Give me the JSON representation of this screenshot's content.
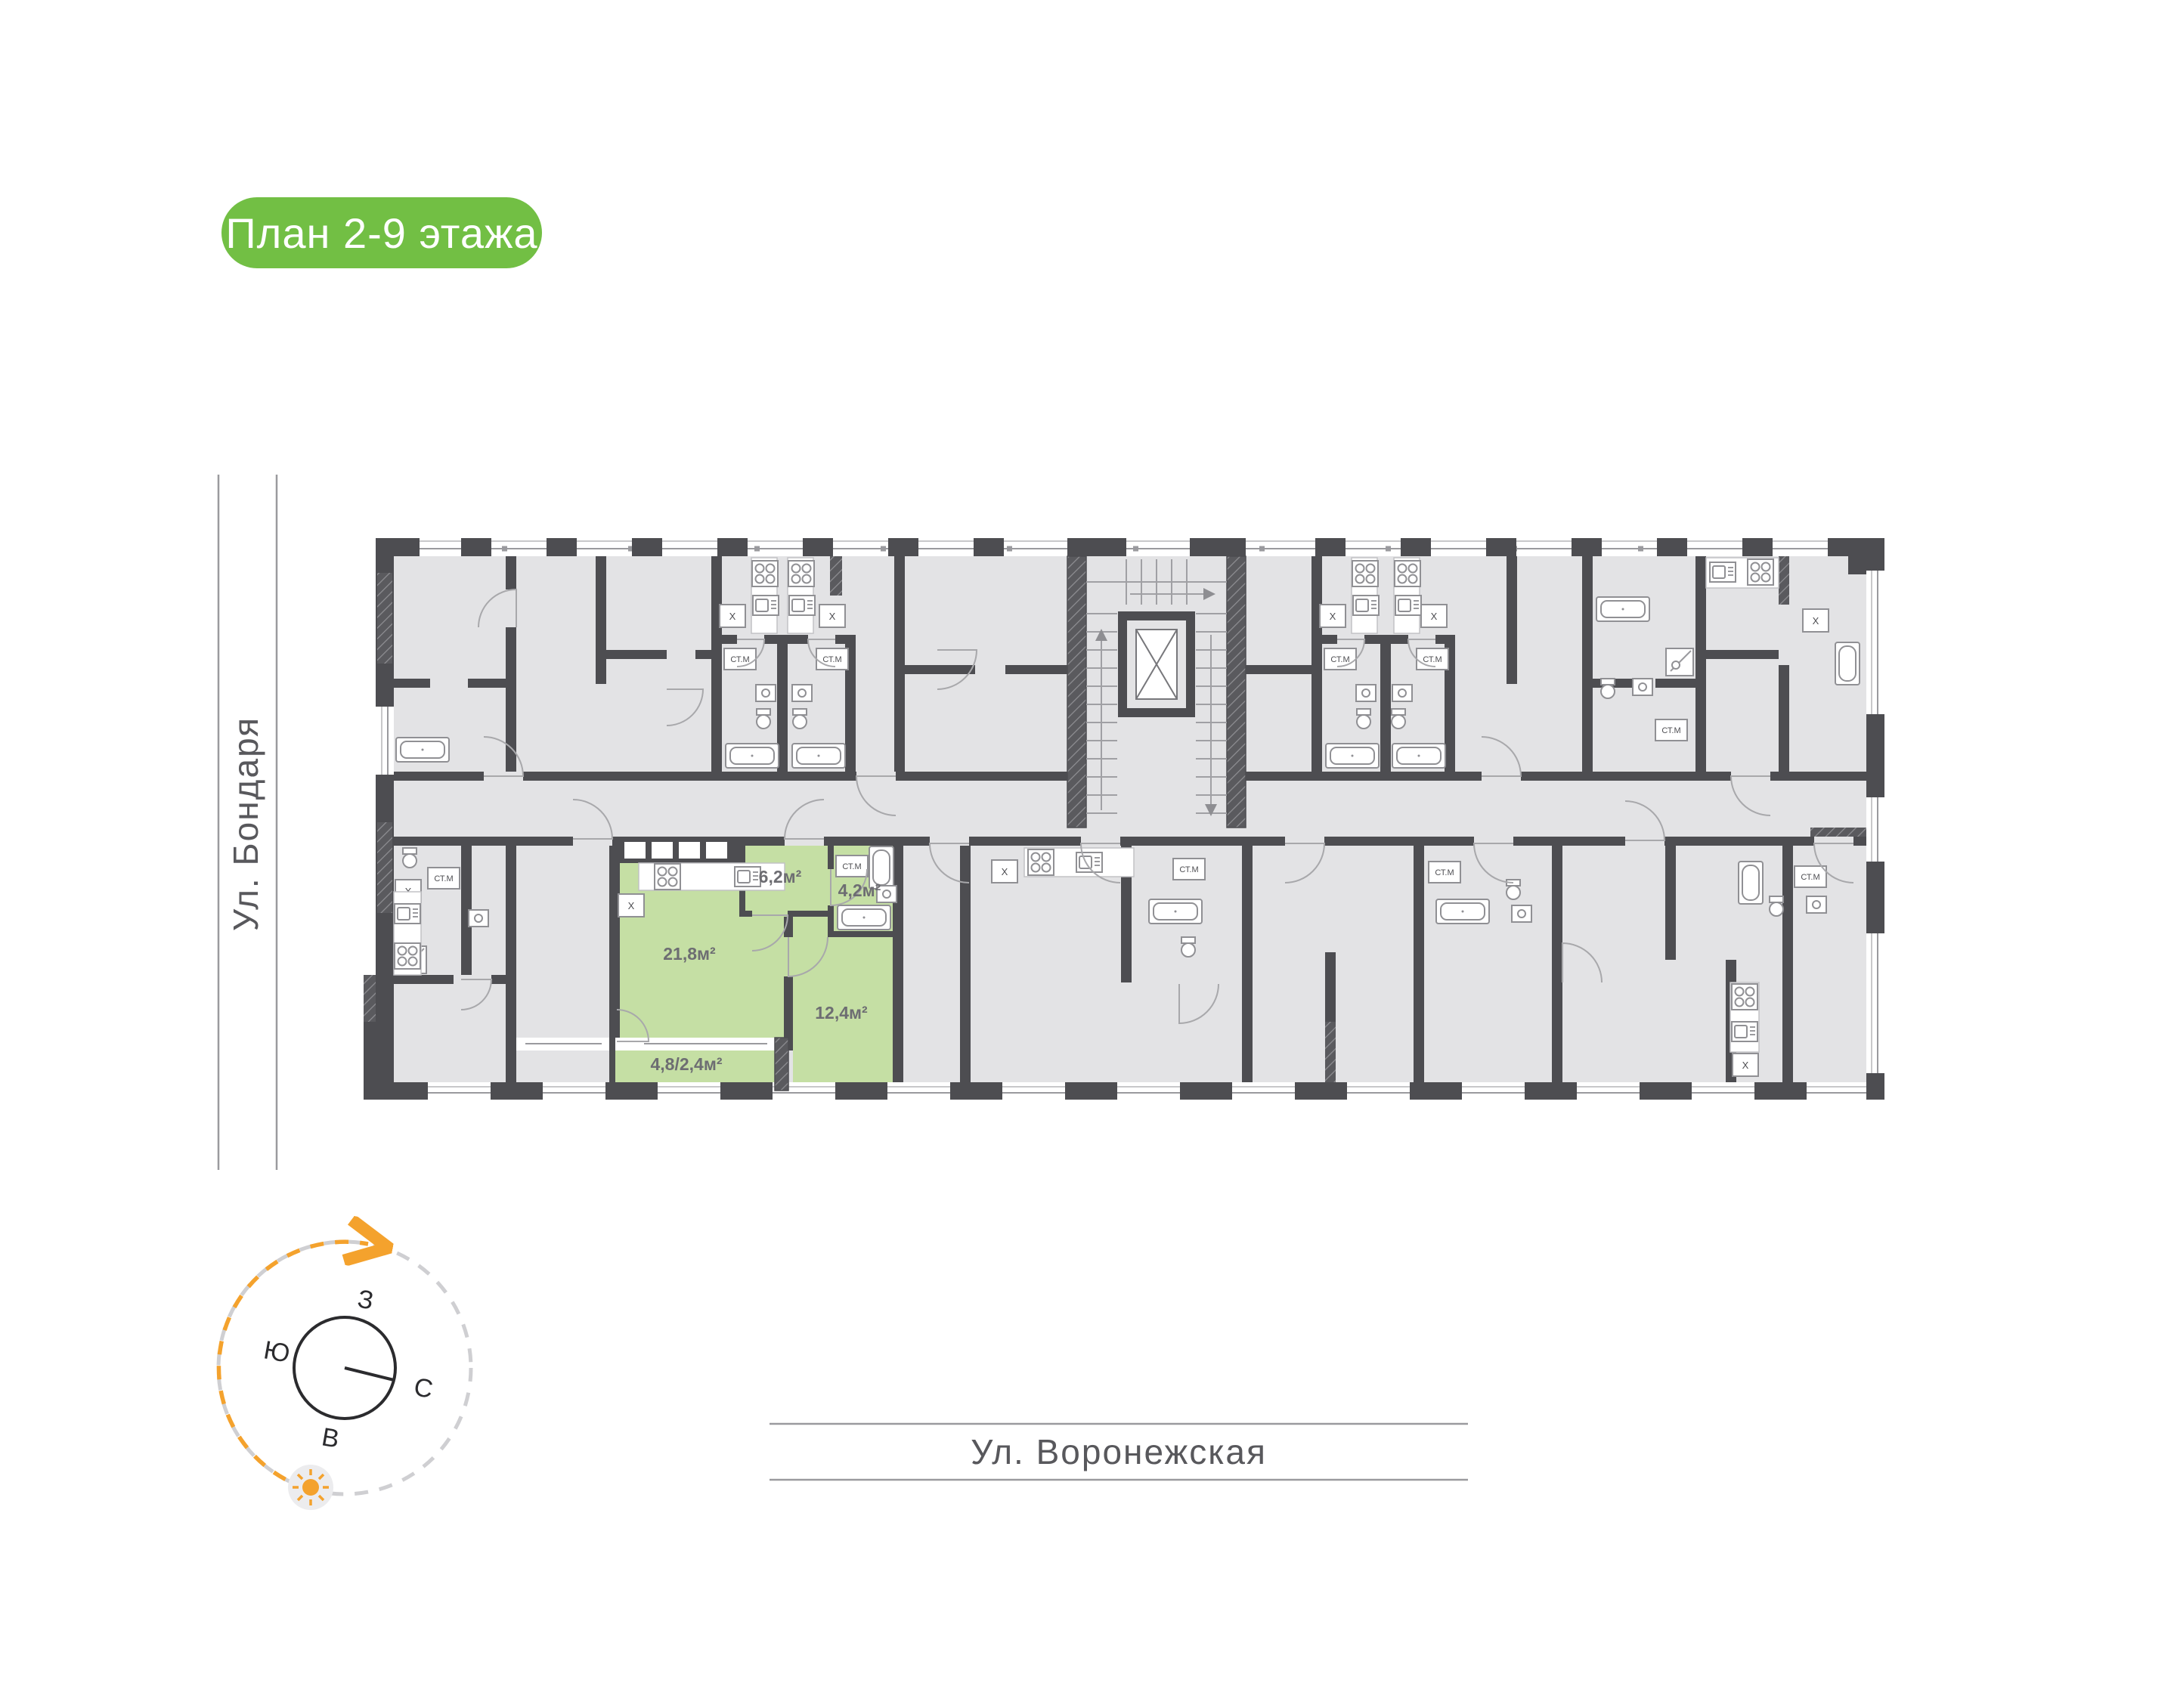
{
  "badge": {
    "label": "План 2-9 этажа"
  },
  "streets": {
    "left": "Ул. Бондаря",
    "bottom": "Ул. Воронежская"
  },
  "compass": {
    "west": "З",
    "south": "Ю",
    "north": "С",
    "east": "В"
  },
  "plan": {
    "highlighted_apartment": {
      "rooms": {
        "hall": "6,2м²",
        "bathroom": "4,2м²",
        "kitchen_living": "21,8м²",
        "bedroom": "12,4м²",
        "balcony": "4,8/2,4м²"
      }
    },
    "labels": {
      "washing_machine": "СТ.М",
      "closet": "X"
    },
    "colors": {
      "highlight": "#c5dfa4",
      "wall": "#4d4d51",
      "room": "#e3e3e5",
      "badge_green": "#72bf44",
      "sun_orange": "#f4a22d"
    }
  }
}
